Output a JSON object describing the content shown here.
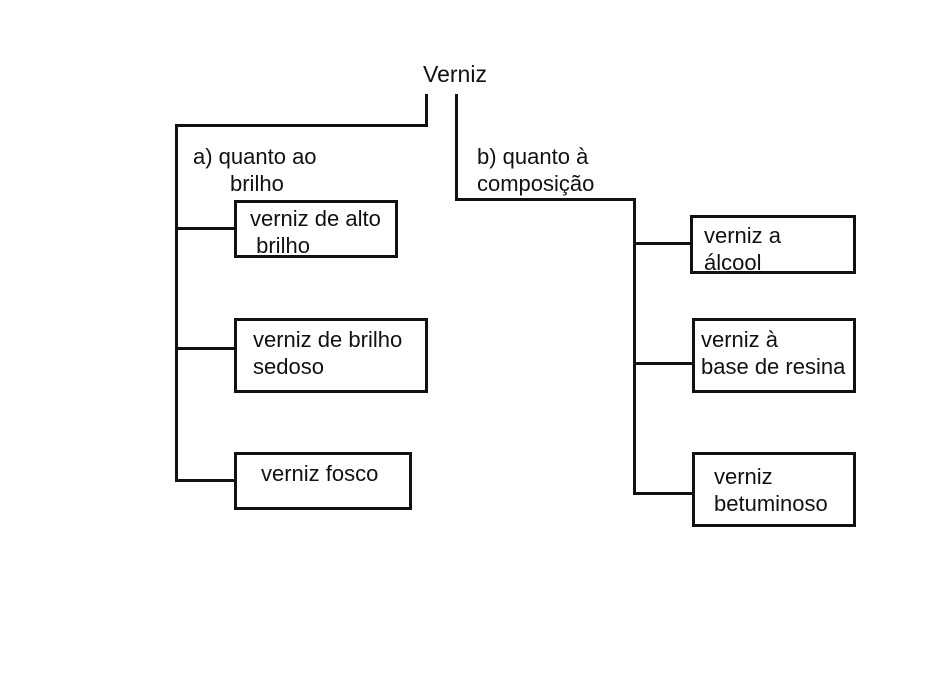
{
  "colors": {
    "line": "#111111",
    "text": "#111111",
    "background": "#ffffff"
  },
  "root": {
    "label": "Verniz"
  },
  "branch_a": {
    "label_line1": "a) quanto ao",
    "label_line2": "brilho",
    "boxes": [
      {
        "text": "verniz de alto\n brilho"
      },
      {
        "text": "verniz de brilho\nsedoso"
      },
      {
        "text": "verniz fosco"
      }
    ]
  },
  "branch_b": {
    "label_line1": "b) quanto à",
    "label_line2": "composição",
    "boxes": [
      {
        "text": "verniz a\nálcool"
      },
      {
        "text": "verniz à\nbase de resina"
      },
      {
        "text": "verniz\nbetuminoso"
      }
    ]
  }
}
